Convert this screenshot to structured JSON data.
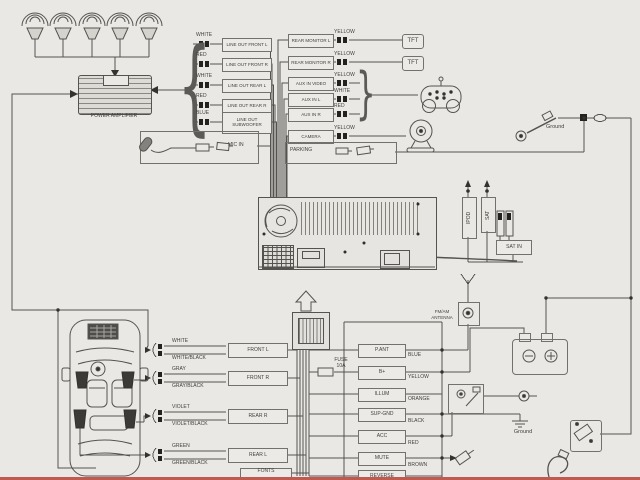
{
  "amplifier_label": "POWER AMPLIFIER",
  "line_outs": [
    {
      "color": "WHITE",
      "label": "LINE OUT FRONT L"
    },
    {
      "color": "RED",
      "label": "LINE OUT FRONT R"
    },
    {
      "color": "WHITE",
      "label": "LINE OUT REAR L"
    },
    {
      "color": "RED",
      "label": "LINE OUT REAR R"
    },
    {
      "color": "BLUE",
      "label": "LINE OUT SUBWOOFER"
    }
  ],
  "mic_label": "MIC IN",
  "av_rows": [
    {
      "label": "REAR MONITOR L",
      "color": "YELLOW"
    },
    {
      "label": "REAR MONITOR R",
      "color": "YELLOW"
    },
    {
      "label": "AUX IN VIDEO",
      "color": "YELLOW"
    },
    {
      "label": "AUX IN L",
      "color": "WHITE"
    },
    {
      "label": "AUX IN R",
      "color": "RED"
    },
    {
      "label": "CAMERA",
      "color": "YELLOW"
    }
  ],
  "tft_labels": [
    "TFT",
    "TFT"
  ],
  "parking_label": "PARKING",
  "ground_top_label": "Ground",
  "ipod_label": "IPOD",
  "sat_label": "SAT",
  "sat_in_label": "SAT IN",
  "antenna_label_1": "FM/AM",
  "antenna_label_2": "ANTENNA",
  "fuse_label_1": "FUSE",
  "fuse_label_2": "10A",
  "harness_rows": [
    {
      "label": "P.ANT",
      "color": "BLUE"
    },
    {
      "label": "B+",
      "color": "YELLOW"
    },
    {
      "label": "ILLUM",
      "color": "ORANGE"
    },
    {
      "label": "SUP-GND",
      "color": "BLACK"
    },
    {
      "label": "ACC",
      "color": "RED"
    },
    {
      "label": "MUTE",
      "color": "BROWN"
    },
    {
      "label": "REVERSE",
      "color": ""
    }
  ],
  "speaker_rows": [
    {
      "wire_top": "WHITE",
      "wire_bottom": "WHITE/BLACK",
      "label": "FRONT L"
    },
    {
      "wire_top": "GRAY",
      "wire_bottom": "GRAY/BLACK",
      "label": "FRONT R"
    },
    {
      "wire_top": "VIOLET",
      "wire_bottom": "VIOLET/BLACK",
      "label": "REAR R"
    },
    {
      "wire_top": "GREEN",
      "wire_bottom": "GREEN/BLACK",
      "label": "REAR L"
    }
  ],
  "partial_box_label": "FONTS",
  "ground_bottom_label": "Ground",
  "colors": {
    "background": "#e9e8e4",
    "line": "#55534f",
    "accent_strip": "#bf5a50"
  },
  "icons": [
    "speaker-icon",
    "power-amplifier-icon",
    "rca-plug-icon",
    "tft-monitor",
    "game-controller-icon",
    "webcam-icon",
    "microphone-icon",
    "ground-bolt-icon",
    "antenna-icon",
    "battery-icon",
    "car-top-view-icon",
    "fuse-icon",
    "ignition-switch-icon",
    "phone-plug-icon",
    "relay-icon",
    "cable-icon",
    "harness-connector-icon",
    "ground-symbol-icon"
  ]
}
